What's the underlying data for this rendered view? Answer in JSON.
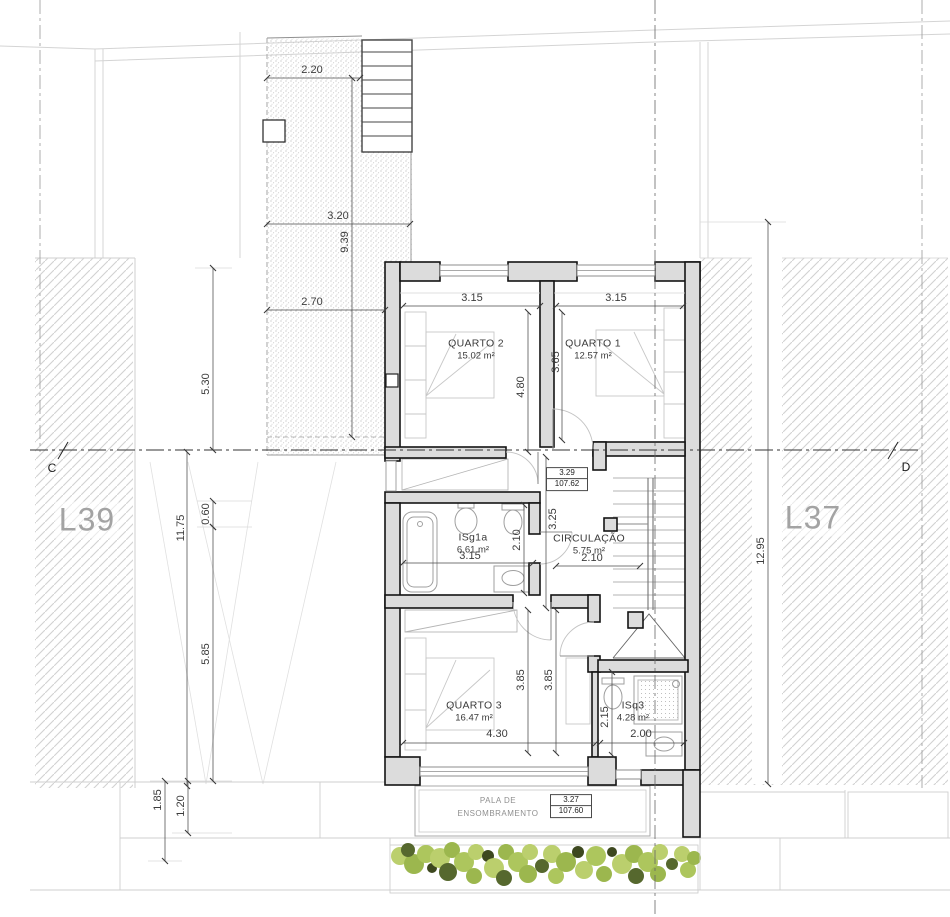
{
  "drawing": {
    "type": "architectural-floor-plan",
    "lots": {
      "left": "L39",
      "right": "L37"
    },
    "section_markers": {
      "left": "C",
      "right": "D"
    },
    "rooms": {
      "quarto2": {
        "name": "QUARTO 2",
        "area": "15.02 m²"
      },
      "quarto1": {
        "name": "QUARTO 1",
        "area": "12.57 m²"
      },
      "isg1a": {
        "name": "ISg1a",
        "area": "6.61 m²"
      },
      "circulacao": {
        "name": "CIRCULAÇÃO",
        "area": "5.75 m²"
      },
      "quarto3": {
        "name": "QUARTO 3",
        "area": "16.47 m²"
      },
      "isq3": {
        "name": "ISq3",
        "area": "4.28 m²"
      }
    },
    "levels": {
      "circulacao": {
        "relative": "3.29",
        "absolute": "107.62"
      },
      "canopy": {
        "relative": "3.27",
        "absolute": "107.60"
      }
    },
    "canopy": {
      "line1": "PALA DE",
      "line2": "ENSOMBRAMENTO"
    },
    "dims": {
      "terrace_top_width": "2.20",
      "terrace_mid_width": "3.20",
      "terrace_height": "9.39",
      "terrace_bottom_width": "2.70",
      "left_upper": "5.30",
      "left_total": "11.75",
      "left_offset": "0.60",
      "left_lower": "5.85",
      "canopy_depth": "1.85",
      "canopy_inner": "1.20",
      "right_total": "12.95",
      "quarto2_width": "3.15",
      "quarto1_width": "3.15",
      "quarto2_depth": "4.80",
      "quarto1_depth": "3.65",
      "isg1a_width": "3.15",
      "isg1a_depth": "2.10",
      "circulacao_depth": "3.25",
      "circulacao_width": "2.10",
      "quarto3_width": "4.30",
      "quarto3_depth_a": "3.85",
      "quarto3_depth_b": "3.85",
      "isq3_depth": "2.15",
      "isq3_width": "2.00"
    },
    "colors": {
      "wall_fill": "#dcdcdc",
      "wall_line": "#141414",
      "hatch_line": "#d2d2d2",
      "lot_label": "#a3a3a3",
      "dim_text": "#3c3c3c",
      "fixture_line": "#9f9f9f",
      "hedge_light": "#b8cd66",
      "hedge_mid": "#97b445",
      "hedge_dark": "#4e6023"
    }
  }
}
